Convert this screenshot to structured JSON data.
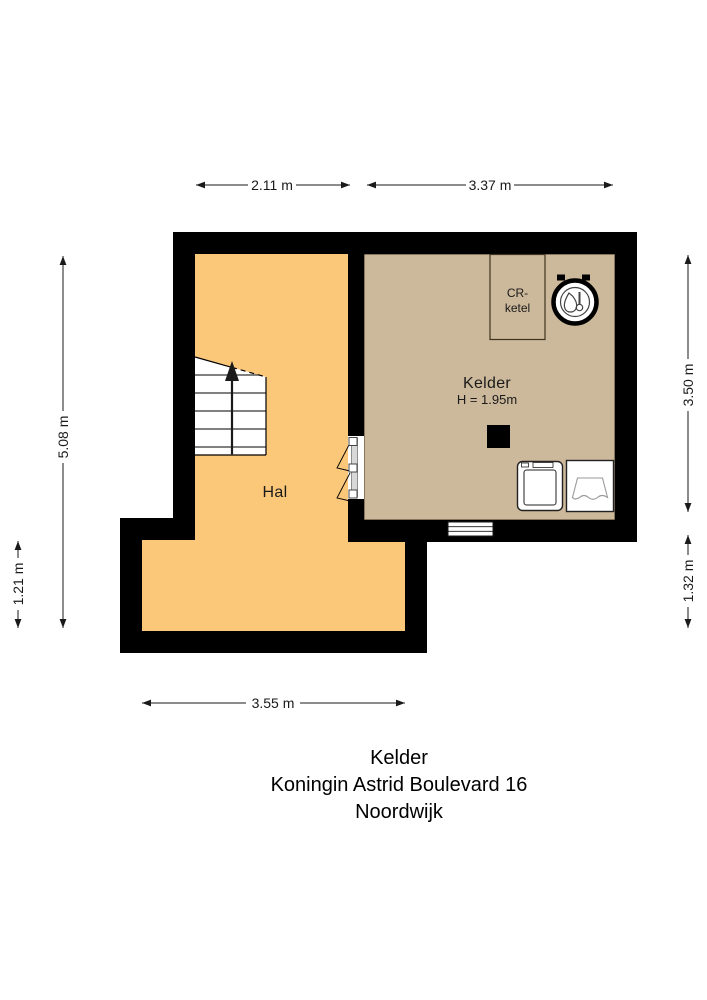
{
  "colors": {
    "hal_floor": "#FBC778",
    "kelder_floor": "#CCB89A",
    "wall": "#000000",
    "outline": "#3F3320"
  },
  "rooms": {
    "hal": {
      "label": "Hal"
    },
    "kelder": {
      "label": "Kelder",
      "ceiling_height": "H = 1.95m"
    }
  },
  "fixtures": {
    "boiler_box": {
      "line1": "CR-",
      "line2": "ketel"
    }
  },
  "dimensions": {
    "top_hal": "2.11 m",
    "top_kelder": "3.37 m",
    "left_full": "5.08 m",
    "left_lower": "1.21 m",
    "right_kelder": "3.50 m",
    "right_lower": "1.32 m",
    "bottom_hal": "3.55 m"
  },
  "title": {
    "line1": "Kelder",
    "line2": "Koningin Astrid Boulevard 16",
    "line3": "Noordwijk"
  }
}
